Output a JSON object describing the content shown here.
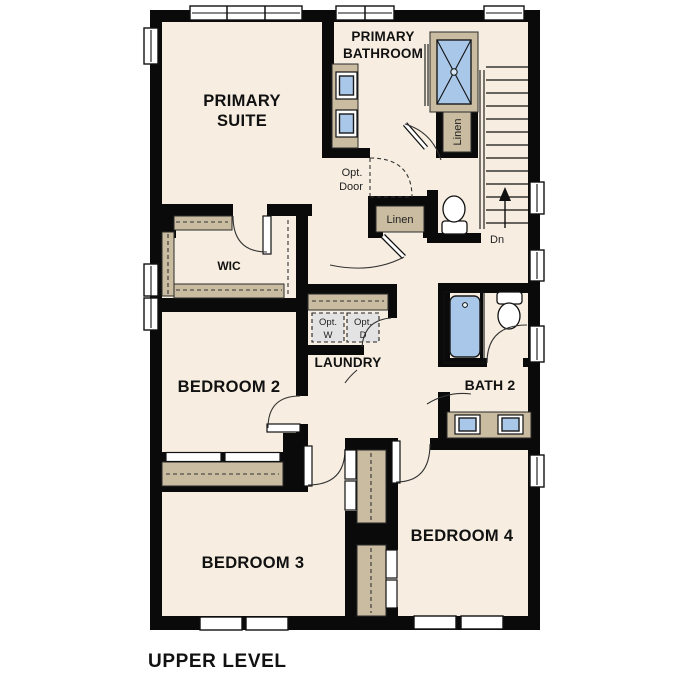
{
  "title": "UPPER LEVEL",
  "rooms": {
    "primary_suite": {
      "l1": "PRIMARY",
      "l2": "SUITE"
    },
    "primary_bathroom": {
      "l1": "PRIMARY",
      "l2": "BATHROOM"
    },
    "wic": {
      "label": "WIC"
    },
    "laundry": {
      "label": "LAUNDRY"
    },
    "bedroom2": {
      "label": "BEDROOM 2"
    },
    "bath2": {
      "label": "BATH 2"
    },
    "bedroom3": {
      "label": "BEDROOM 3"
    },
    "bedroom4": {
      "label": "BEDROOM 4"
    }
  },
  "annotations": {
    "opt_door": {
      "l1": "Opt.",
      "l2": "Door"
    },
    "opt_washer": {
      "l1": "Opt.",
      "l2": "W"
    },
    "opt_dryer": {
      "l1": "Opt.",
      "l2": "D"
    },
    "linen_hall": "Linen",
    "linen_bath": "Linen",
    "stairs_down": "Dn"
  },
  "colors": {
    "floor": "#f7eee1",
    "wall": "#0a0a0a",
    "cabinet_tan": "#cabca0",
    "fixture_blue": "#a9c7e8",
    "optional_gray": "#e3e3e3"
  }
}
